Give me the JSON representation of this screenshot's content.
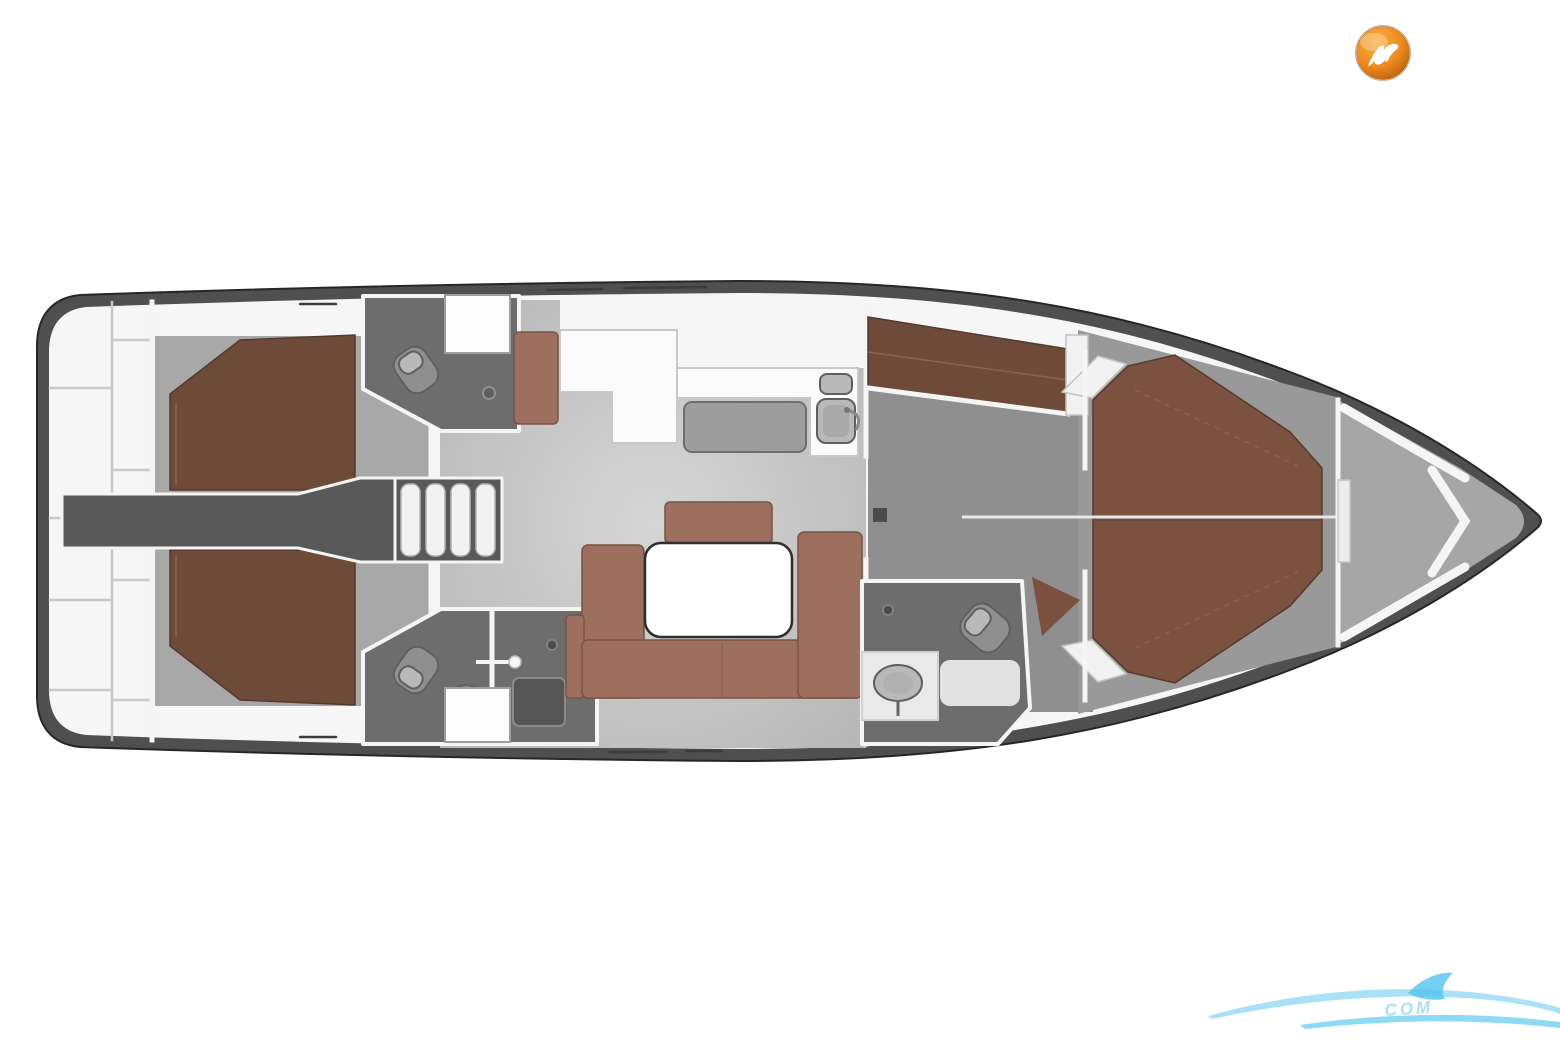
{
  "figure": {
    "type": "yacht-deck-plan",
    "view": "top-down interior layout",
    "orientation": "stern-left-bow-right"
  },
  "floorplan": {
    "rooms": [
      {
        "id": "swim-platform",
        "label": "Transom swim platform with step panels"
      },
      {
        "id": "aft-cabin-port",
        "label": "Aft double cabin, port"
      },
      {
        "id": "aft-cabin-starboard",
        "label": "Aft double cabin, starboard"
      },
      {
        "id": "aft-head-port",
        "label": "Aft head with toilet, basin and shower, port"
      },
      {
        "id": "aft-head-starboard",
        "label": "Aft head with separate shower stall, starboard"
      },
      {
        "id": "engine-compartment",
        "label": "Engine compartment under cockpit"
      },
      {
        "id": "companionway-steps",
        "label": "Companionway steps"
      },
      {
        "id": "nav-station",
        "label": "Chart table with navigator seat"
      },
      {
        "id": "galley",
        "label": "Galley with stove and double sink"
      },
      {
        "id": "salon",
        "label": "Salon with U-shaped settee, table and bench"
      },
      {
        "id": "passageway",
        "label": "Passageway with port single berth"
      },
      {
        "id": "forward-head",
        "label": "Forward head with shower, toilet and basin"
      },
      {
        "id": "owner-cabin",
        "label": "Forward owner cabin with island double berth"
      },
      {
        "id": "anchor-locker",
        "label": "Bow anchor locker with V-struts"
      }
    ]
  },
  "branding": {
    "logo": {
      "icon": "bird-icon",
      "shape": "orange sphere badge"
    }
  },
  "watermark": {
    "icon": "wave-swoosh-icon",
    "text": "COM"
  },
  "colors": {
    "hull_outer": "#4f4f4f",
    "hull_outline": "#262626",
    "hull_inner": "#f6f6f6",
    "wall_white": "#f5f5f5",
    "wall_edge": "#c8c8c8",
    "floor_light": "#d6d6d6",
    "floor_shade": "#b2b2b2",
    "floor_mid": "#a8a8a8",
    "floor_corridor": "#8f8f8f",
    "floor_owner": "#999999",
    "floor_bow": "#a6a6a6",
    "head_floor": "#6d6d6d",
    "engine_dark": "#595959",
    "bed_dark": "#6e4a39",
    "bed_fwd": "#7b523f",
    "bed_edge": "#55392c",
    "bed_seam": "#8a6450",
    "sofa": "#9c6f5e",
    "sofa_edge": "#7a5344",
    "counter_white": "#fbfbfb",
    "stove_gray": "#9e9e9e",
    "stove_edge": "#6e6e6e",
    "table_white": "#ffffff",
    "table_edge": "#2e2e2e",
    "fixture_gray": "#b9b9b9",
    "fixture_dark": "#8f8f8f",
    "fixture_edge": "#5f5f5f",
    "shower_tray": "#555555",
    "step_tread": "#f2f2f2",
    "logo_orange_light": "#f9b045",
    "logo_orange": "#ed8a1e",
    "logo_orange_dark": "#a85408",
    "logo_ring": "#8a4a08",
    "logo_glyph": "#ffffff",
    "watermark_blue": "#8ed7f3",
    "watermark_blue_dark": "#52c4ee"
  }
}
